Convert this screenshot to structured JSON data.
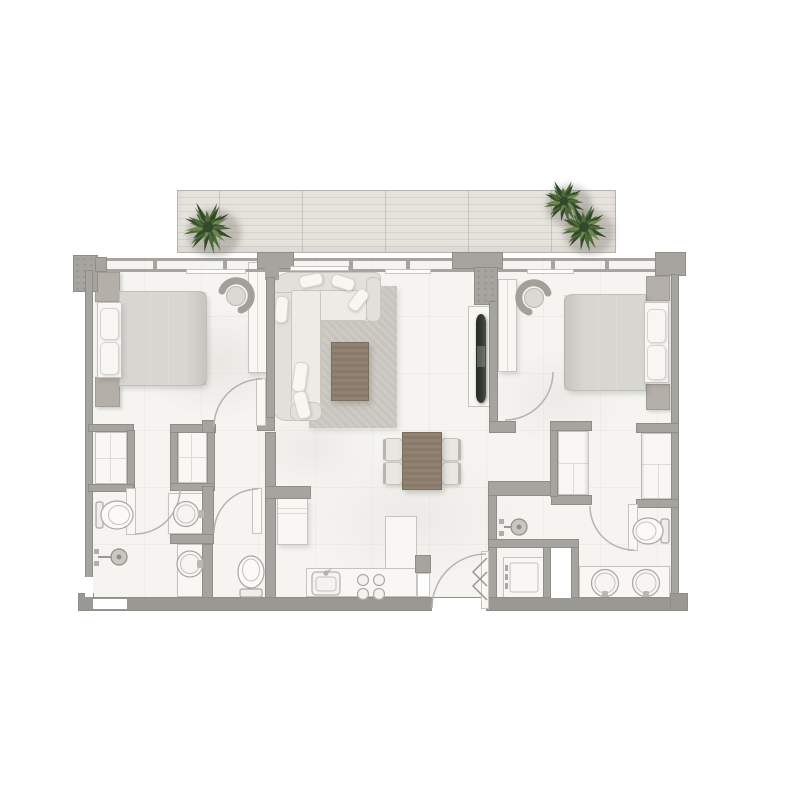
{
  "scene": {
    "kind": "apartment-floor-plan-top-view",
    "visible_text": [],
    "rooms_depicted": [
      "balcony-terrace",
      "bedroom-left",
      "living-dining-room",
      "bedroom-right",
      "bathroom-left",
      "wc-left",
      "bathroom-right",
      "kitchen",
      "entry-hall",
      "wardrobe-closets",
      "laundry-closet"
    ],
    "inventory": {
      "balcony_plants": 3,
      "beds": 2,
      "bedside_tables": 4,
      "bedroom_chairs": 2,
      "sofa_sectional": 1,
      "coffee_table": 1,
      "area_rug": 1,
      "tv_unit": 1,
      "dining_table": 1,
      "dining_chairs": 4,
      "cooktop_burners": 4,
      "kitchen_sink": 1,
      "fridge_tall_unit": 1,
      "bathroom_basins": 4,
      "toilets": 3,
      "showers": 2,
      "washing_machine": 1,
      "door_swings": 6,
      "closet_units": 4
    }
  },
  "colors": {
    "wall": "#a6a49f",
    "wall_edge": "#8f8d88",
    "wall_dark": "#9a9892",
    "floor": "#f5f4f1",
    "deck": "#e6e3dd",
    "deck_line": "#d7d4cd",
    "furn": "#f8f7f4",
    "furn_edge": "#c6c4be",
    "furn_line": "#dddbd6",
    "sofa": "#e2e0db",
    "sofa_seat": "#edebe6",
    "sofa_edge": "#c8c6c0",
    "rug": "#cbc7c1",
    "wood": "#8d7e6c",
    "wood_edge": "#7c6e5e",
    "bed": "#d8d6d1",
    "bed_edge": "#c2c0ba",
    "stand": "#b4afa8",
    "stand_edge": "#a19c95",
    "tv": "#353b31",
    "plant_dark": "#34492b",
    "plant_mid": "#4e6a39",
    "plant_light": "#6c8a4f",
    "stroke": "#a9a7a2",
    "arc": "#b6b4af"
  }
}
